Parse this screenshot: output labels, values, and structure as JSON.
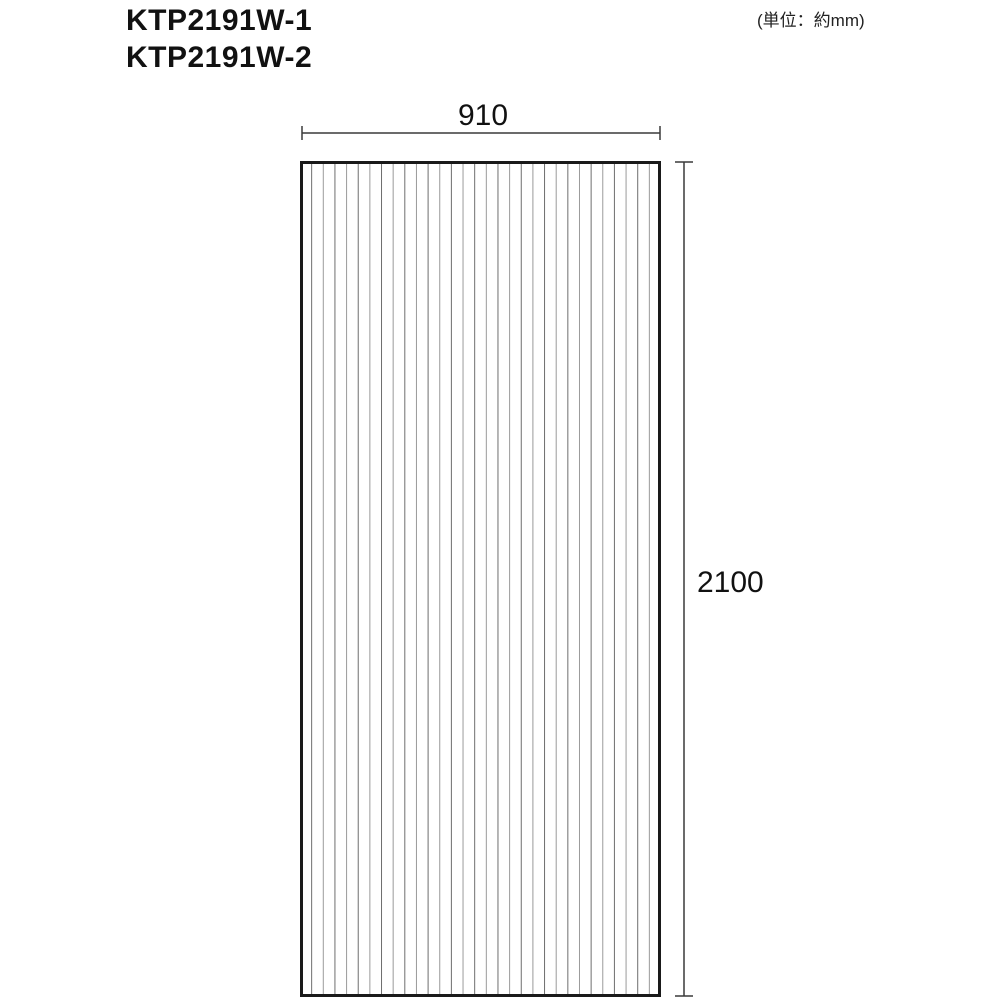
{
  "header": {
    "models": [
      "KTP2191W-1",
      "KTP2191W-2"
    ],
    "unit_note": "(単位：約mm)"
  },
  "diagram": {
    "type": "dimension-drawing",
    "panel": {
      "description": "corrugated-sheet-front-view",
      "width_mm": 910,
      "height_mm": 2100,
      "width_label": "910",
      "height_label": "2100",
      "stripe_count": 30,
      "stripe_orientation": "vertical"
    },
    "colors": {
      "outline": "#1a1a1a",
      "stripe_dark": "#6e6e6e",
      "stripe_light": "#9a9a9a",
      "dimension_line": "#3a3a3a",
      "text": "#111111",
      "background": "#ffffff"
    }
  }
}
